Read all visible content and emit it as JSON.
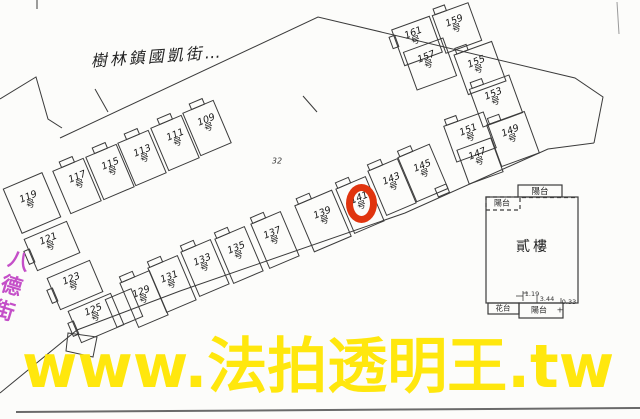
{
  "map": {
    "street_label_top": "樹林鎮國凱街…",
    "street_label_left": "八德街",
    "lot_number": "32",
    "unit_suffix": "号",
    "units": [
      {
        "n": "109",
        "s": "号",
        "x": 208,
        "y": 124
      },
      {
        "n": "111",
        "s": "号",
        "x": 177,
        "y": 139
      },
      {
        "n": "113",
        "s": "号",
        "x": 144,
        "y": 155
      },
      {
        "n": "115",
        "s": "号",
        "x": 112,
        "y": 168
      },
      {
        "n": "117",
        "s": "号",
        "x": 79,
        "y": 181
      },
      {
        "n": "119",
        "s": "号",
        "x": 30,
        "y": 201
      },
      {
        "n": "121",
        "s": "号",
        "x": 50,
        "y": 243
      },
      {
        "n": "123",
        "s": "号",
        "x": 73,
        "y": 283
      },
      {
        "n": "125",
        "s": "号",
        "x": 95,
        "y": 314
      },
      {
        "n": "129",
        "s": "号",
        "x": 143,
        "y": 296
      },
      {
        "n": "131",
        "s": "号",
        "x": 171,
        "y": 281
      },
      {
        "n": "133",
        "s": "号",
        "x": 204,
        "y": 264
      },
      {
        "n": "135",
        "s": "号",
        "x": 238,
        "y": 252
      },
      {
        "n": "137",
        "s": "号",
        "x": 274,
        "y": 237
      },
      {
        "n": "139",
        "s": "号",
        "x": 324,
        "y": 217
      },
      {
        "n": "141",
        "s": "号",
        "x": 361,
        "y": 202,
        "highlighted": true
      },
      {
        "n": "143",
        "s": "号",
        "x": 393,
        "y": 183
      },
      {
        "n": "145",
        "s": "号",
        "x": 424,
        "y": 170
      },
      {
        "n": "147",
        "s": "号",
        "x": 479,
        "y": 158
      },
      {
        "n": "149",
        "s": "号",
        "x": 512,
        "y": 135
      },
      {
        "n": "151",
        "s": "号",
        "x": 470,
        "y": 134
      },
      {
        "n": "153",
        "s": "号",
        "x": 495,
        "y": 98
      },
      {
        "n": "155",
        "s": "号",
        "x": 478,
        "y": 66
      },
      {
        "n": "157",
        "s": "号",
        "x": 428,
        "y": 61
      },
      {
        "n": "159",
        "s": "号",
        "x": 456,
        "y": 25
      },
      {
        "n": "161",
        "s": "号",
        "x": 415,
        "y": 37
      }
    ],
    "highlight": {
      "unit": "141号",
      "ring_color": "#e0340e"
    }
  },
  "floor_plan": {
    "room_label": "貳樓",
    "balcony_top": "陽台",
    "balcony_left": "陽台",
    "balcony_bottom": "陽台",
    "balcony_bottom_mark": "+",
    "flower_bed": "花台",
    "dim_1": "1.19",
    "dim_2": "3.44",
    "dim_3": "0.33"
  },
  "watermark": {
    "text": "www.法拍透明王.tw",
    "color": "#ffe70d"
  },
  "colors": {
    "line": "#3b3b3b",
    "street_left_text": "#c44fc8",
    "highlight_ring": "#e0340e",
    "watermark": "#ffe70d",
    "background": "#fcfcfa"
  }
}
